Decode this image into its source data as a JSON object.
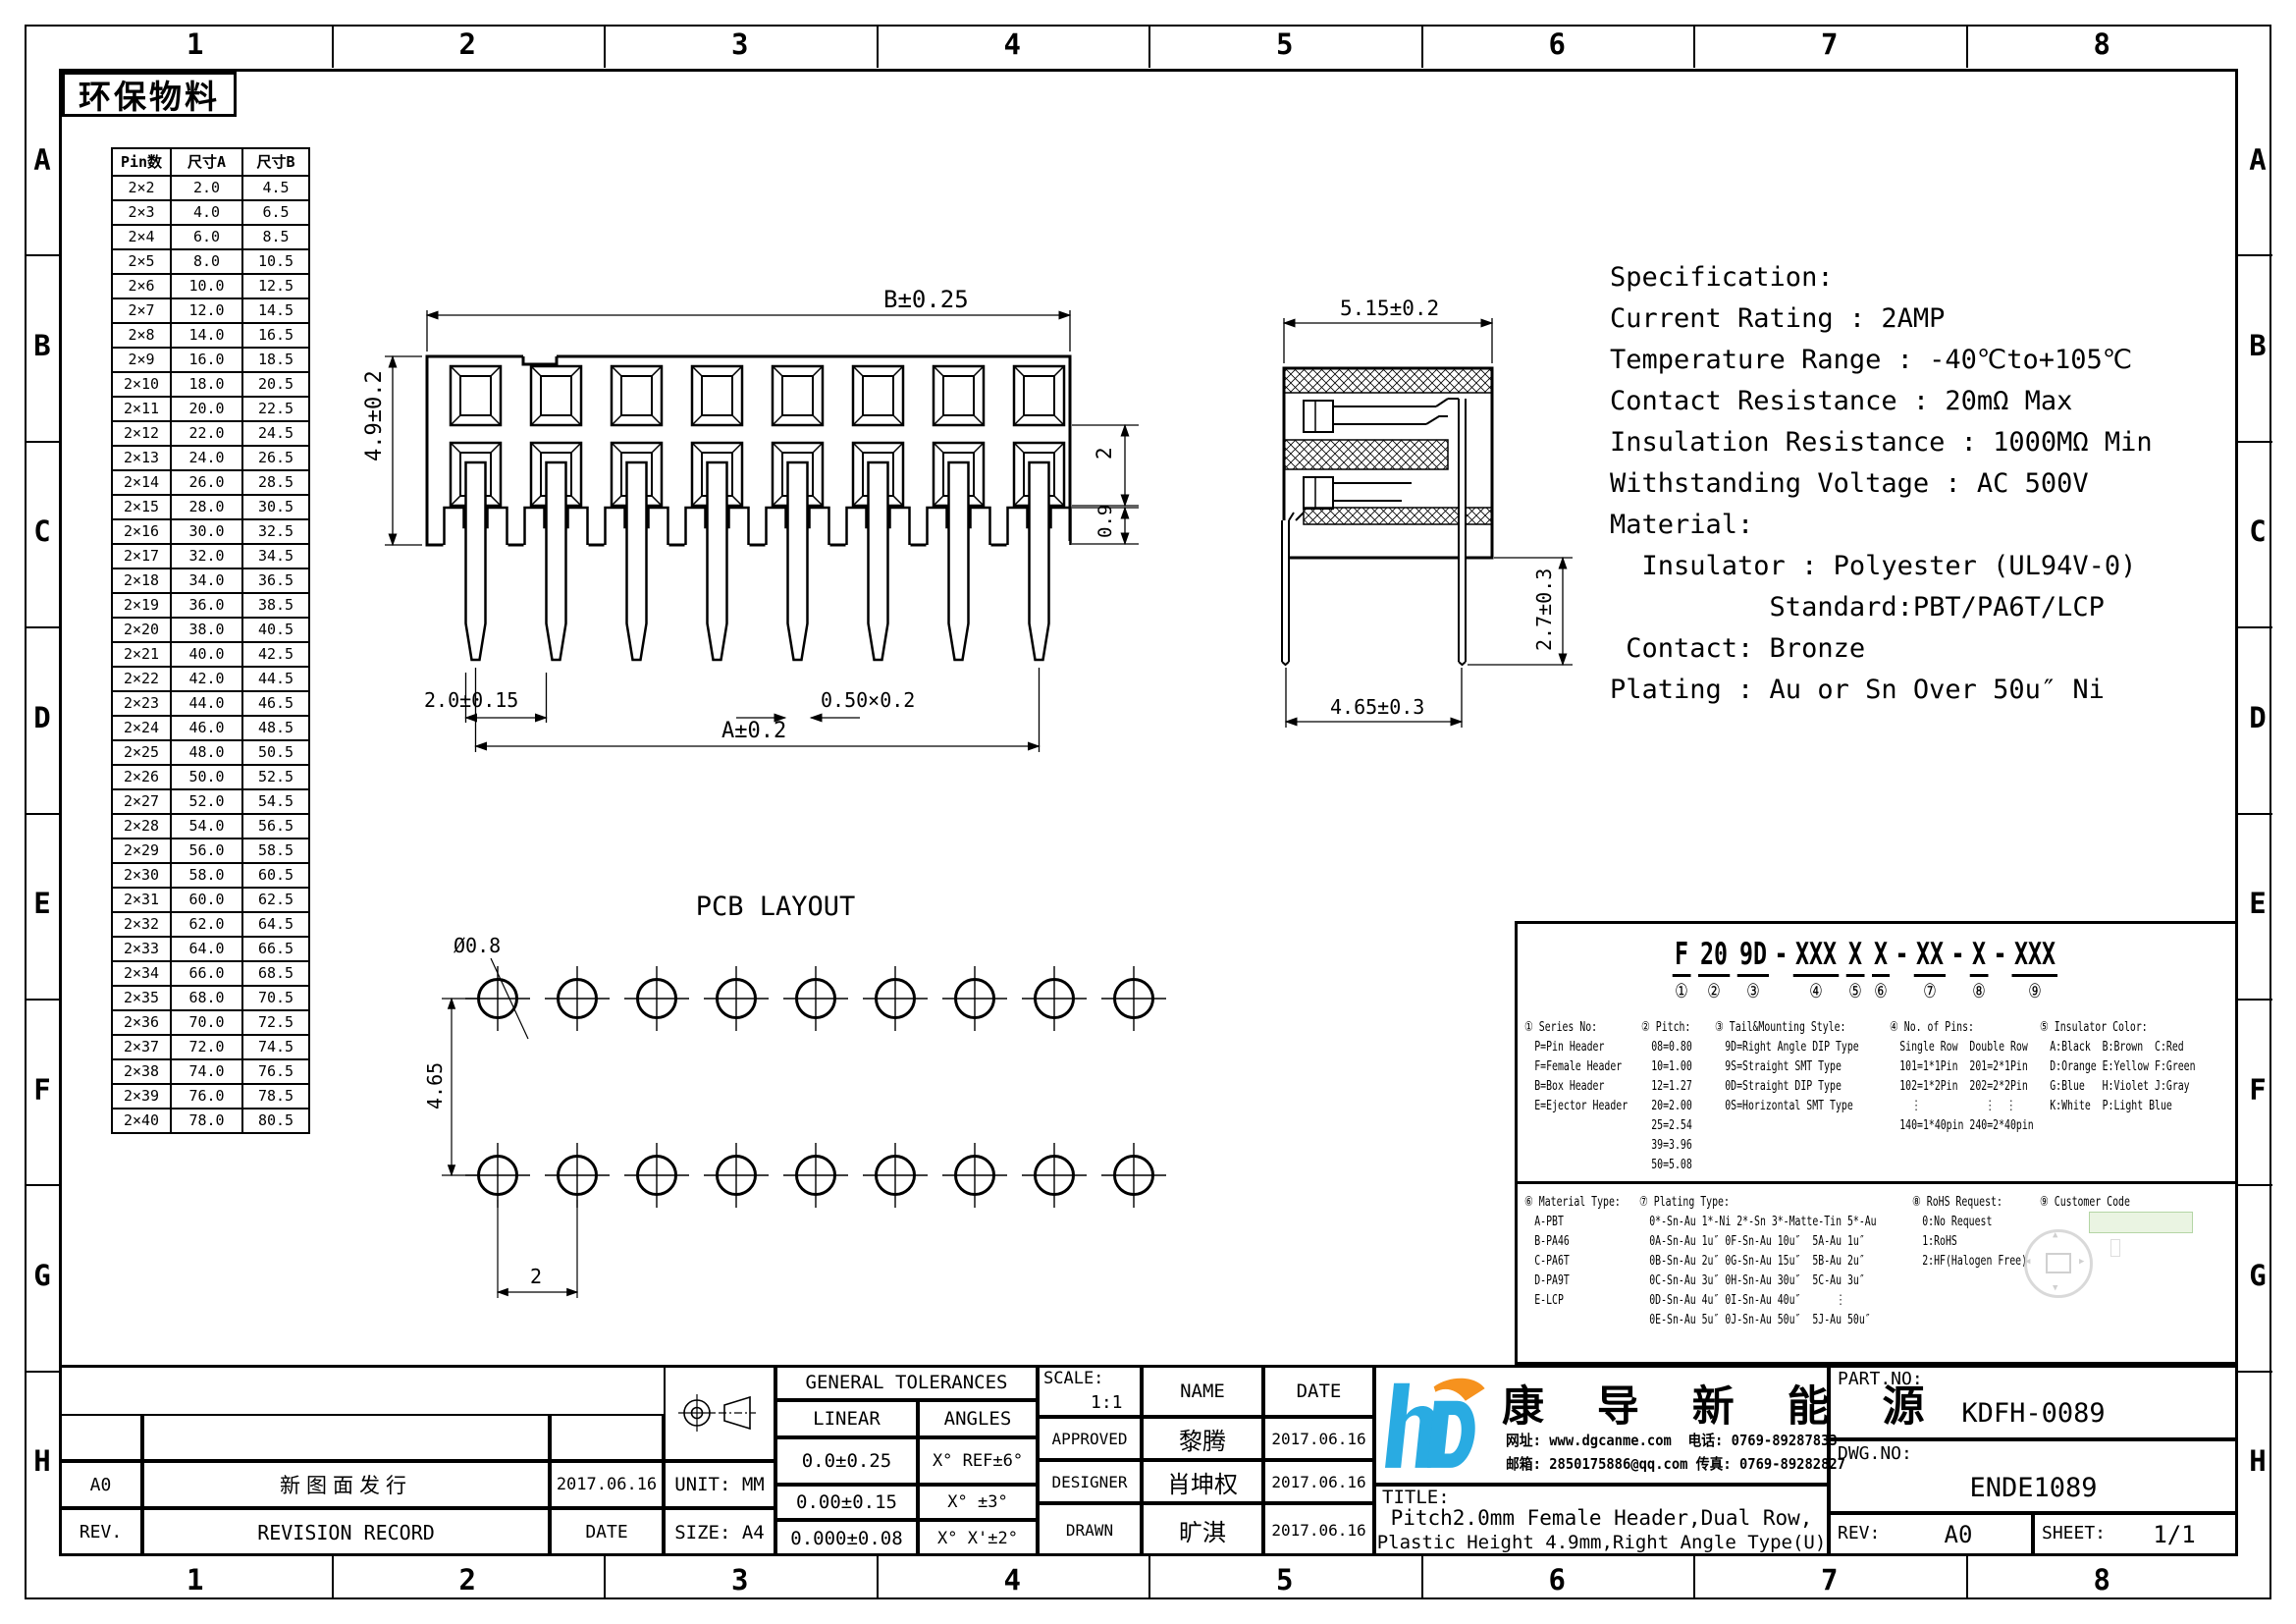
{
  "border": {
    "cols": [
      "1",
      "2",
      "3",
      "4",
      "5",
      "6",
      "7",
      "8"
    ],
    "rows": [
      "A",
      "B",
      "C",
      "D",
      "E",
      "F",
      "G",
      "H"
    ]
  },
  "eco_label": "环保物料",
  "pin_table": {
    "headers": [
      "Pin数",
      "尺寸A",
      "尺寸B"
    ],
    "rows": [
      [
        "2×2",
        "2.0",
        "4.5"
      ],
      [
        "2×3",
        "4.0",
        "6.5"
      ],
      [
        "2×4",
        "6.0",
        "8.5"
      ],
      [
        "2×5",
        "8.0",
        "10.5"
      ],
      [
        "2×6",
        "10.0",
        "12.5"
      ],
      [
        "2×7",
        "12.0",
        "14.5"
      ],
      [
        "2×8",
        "14.0",
        "16.5"
      ],
      [
        "2×9",
        "16.0",
        "18.5"
      ],
      [
        "2×10",
        "18.0",
        "20.5"
      ],
      [
        "2×11",
        "20.0",
        "22.5"
      ],
      [
        "2×12",
        "22.0",
        "24.5"
      ],
      [
        "2×13",
        "24.0",
        "26.5"
      ],
      [
        "2×14",
        "26.0",
        "28.5"
      ],
      [
        "2×15",
        "28.0",
        "30.5"
      ],
      [
        "2×16",
        "30.0",
        "32.5"
      ],
      [
        "2×17",
        "32.0",
        "34.5"
      ],
      [
        "2×18",
        "34.0",
        "36.5"
      ],
      [
        "2×19",
        "36.0",
        "38.5"
      ],
      [
        "2×20",
        "38.0",
        "40.5"
      ],
      [
        "2×21",
        "40.0",
        "42.5"
      ],
      [
        "2×22",
        "42.0",
        "44.5"
      ],
      [
        "2×23",
        "44.0",
        "46.5"
      ],
      [
        "2×24",
        "46.0",
        "48.5"
      ],
      [
        "2×25",
        "48.0",
        "50.5"
      ],
      [
        "2×26",
        "50.0",
        "52.5"
      ],
      [
        "2×27",
        "52.0",
        "54.5"
      ],
      [
        "2×28",
        "54.0",
        "56.5"
      ],
      [
        "2×29",
        "56.0",
        "58.5"
      ],
      [
        "2×30",
        "58.0",
        "60.5"
      ],
      [
        "2×31",
        "60.0",
        "62.5"
      ],
      [
        "2×32",
        "62.0",
        "64.5"
      ],
      [
        "2×33",
        "64.0",
        "66.5"
      ],
      [
        "2×34",
        "66.0",
        "68.5"
      ],
      [
        "2×35",
        "68.0",
        "70.5"
      ],
      [
        "2×36",
        "70.0",
        "72.5"
      ],
      [
        "2×37",
        "72.0",
        "74.5"
      ],
      [
        "2×38",
        "74.0",
        "76.5"
      ],
      [
        "2×39",
        "76.0",
        "78.5"
      ],
      [
        "2×40",
        "78.0",
        "80.5"
      ]
    ]
  },
  "front_view": {
    "positions": 8,
    "dim_width": "B±0.25",
    "dim_height": "4.9±0.2",
    "dim_pitch": "2.0±0.15",
    "dim_pin": "0.50×0.2",
    "dim_overall": "A±0.2",
    "dim_row_space": "2",
    "dim_tail": "0.9"
  },
  "side_view": {
    "dim_depth": "5.15±0.2",
    "dim_tail_len": "2.7±0.3",
    "dim_leg_span": "4.65±0.3"
  },
  "spec_lines": [
    "Specification:",
    "Current Rating : 2AMP",
    "Temperature Range : -40℃to+105℃",
    "Contact Resistance : 20mΩ Max",
    "Insulation Resistance : 1000MΩ Min",
    "Withstanding Voltage : AC 500V",
    "Material:",
    "  Insulator : Polyester (UL94V-0)",
    "          Standard:PBT/PA6T/LCP",
    " Contact: Bronze",
    "Plating : Au or Sn Over 50u″ Ni"
  ],
  "pcb": {
    "title": "PCB LAYOUT",
    "columns": 9,
    "rows": 2,
    "dim_hole": "Ø0.8",
    "dim_row_pitch": "4.65",
    "dim_col_pitch": "2"
  },
  "ordering": {
    "code": [
      {
        "t": "F",
        "n": "①"
      },
      {
        "t": "20",
        "n": "②"
      },
      {
        "t": "9D",
        "n": "③"
      },
      {
        "sep": "-"
      },
      {
        "t": "XXX",
        "n": "④"
      },
      {
        "t": "X",
        "n": "⑤"
      },
      {
        "t": "X",
        "n": "⑥"
      },
      {
        "sep": "-"
      },
      {
        "t": "XX",
        "n": "⑦"
      },
      {
        "sep": "-"
      },
      {
        "t": "X",
        "n": "⑧"
      },
      {
        "sep": "-"
      },
      {
        "t": "XXX",
        "n": "⑨"
      }
    ],
    "top_sections": [
      {
        "title": "① Series No:",
        "lines": [
          "P=Pin Header",
          "F=Female Header",
          "B=Box Header",
          "E=Ejector Header"
        ]
      },
      {
        "title": "② Pitch:",
        "lines": [
          "08=0.80",
          "10=1.00",
          "12=1.27",
          "20=2.00",
          "25=2.54",
          "39=3.96",
          "50=5.08"
        ]
      },
      {
        "title": "③ Tail&Mounting Style:",
        "lines": [
          "9D=Right Angle DIP Type",
          "9S=Straight SMT Type",
          "0D=Straight DIP Type",
          "0S=Horizontal SMT Type"
        ]
      },
      {
        "title": "④ No. of Pins:",
        "lines": [
          "Single Row  Double Row",
          "101=1*1Pin  201=2*1Pin",
          "102=1*2Pin  202=2*2Pin",
          "  ⋮           ⋮  ⋮",
          "140=1*40pin 240=2*40pin"
        ]
      },
      {
        "title": "⑤ Insulator Color:",
        "lines": [
          "A:Black  B:Brown  C:Red",
          "D:Orange E:Yellow F:Green",
          "G:Blue   H:Violet J:Gray",
          "K:White  P:Light Blue"
        ]
      }
    ],
    "bottom_sections": [
      {
        "title": "⑥ Material Type:",
        "lines": [
          "A-PBT",
          "B-PA46",
          "C-PA6T",
          "D-PA9T",
          "E-LCP"
        ]
      },
      {
        "title": "⑦ Plating Type:",
        "lines": [
          "0*-Sn-Au 1*-Ni 2*-Sn 3*-Matte-Tin 5*-Au",
          "0A-Sn-Au 1u″ 0F-Sn-Au 10u″  5A-Au 1u″",
          "0B-Sn-Au 2u″ 0G-Sn-Au 15u″  5B-Au 2u″",
          "0C-Sn-Au 3u″ 0H-Sn-Au 30u″  5C-Au 3u″",
          "0D-Sn-Au 4u″ 0I-Sn-Au 40u″      ⋮",
          "0E-Sn-Au 5u″ 0J-Sn-Au 50u″  5J-Au 50u″"
        ]
      },
      {
        "title": "⑧ RoHS Request:",
        "lines": [
          "0:No Request",
          "1:RoHS",
          "2:HF(Halogen Free)"
        ]
      },
      {
        "title": "⑨ Customer Code",
        "lines": []
      }
    ]
  },
  "titleblock": {
    "revision": {
      "rev": "A0",
      "record": "新图面发行",
      "date": "2017.06.16",
      "h_rev": "REV.",
      "h_record": "REVISION RECORD",
      "h_date": "DATE"
    },
    "tol_title": "GENERAL TOLERANCES",
    "tol_linear": "LINEAR",
    "tol_angles": "ANGLES",
    "tol_rows": [
      [
        "0.0±0.25",
        "X° REF±6°"
      ],
      [
        "0.00±0.15",
        "X° ±3°"
      ],
      [
        "0.000±0.08",
        "X° X'±2°"
      ]
    ],
    "unit": "UNIT: MM",
    "size": "SIZE: A4",
    "scale_label": "SCALE:",
    "scale_value": "1:1",
    "name_label": "NAME",
    "date_label": "DATE",
    "signoff": [
      [
        "APPROVED",
        "黎腾",
        "2017.06.16"
      ],
      [
        "DESIGNER",
        "肖坤权",
        "2017.06.16"
      ],
      [
        "DRAWN",
        "旷淇",
        "2017.06.16"
      ]
    ],
    "title_label": "TITLE:",
    "title_line1": "Pitch2.0mm Female Header,Dual Row,",
    "title_line2": "Plastic Height 4.9mm,Right Angle Type(U)",
    "part_no_label": "PART.NO:",
    "part_no": "KDFH-0089",
    "dwg_no_label": "DWG.NO:",
    "dwg_no": "ENDE1089",
    "rev_label": "REV:",
    "rev": "A0",
    "sheet_label": "SHEET:",
    "sheet": "1/1"
  },
  "company": {
    "name": "康 导 新 能 源",
    "contact1": "网址: www.dgcanme.com  电话: 0769-89287833",
    "contact2": "邮箱: 2850175886@qq.com 传真: 0769-89282827",
    "logo_icon": "hd-logo"
  },
  "colors": {
    "line": "#000000",
    "logo_blue": "#29abe2",
    "logo_orange": "#f6921e",
    "stamp_green": "#e7f3de"
  }
}
